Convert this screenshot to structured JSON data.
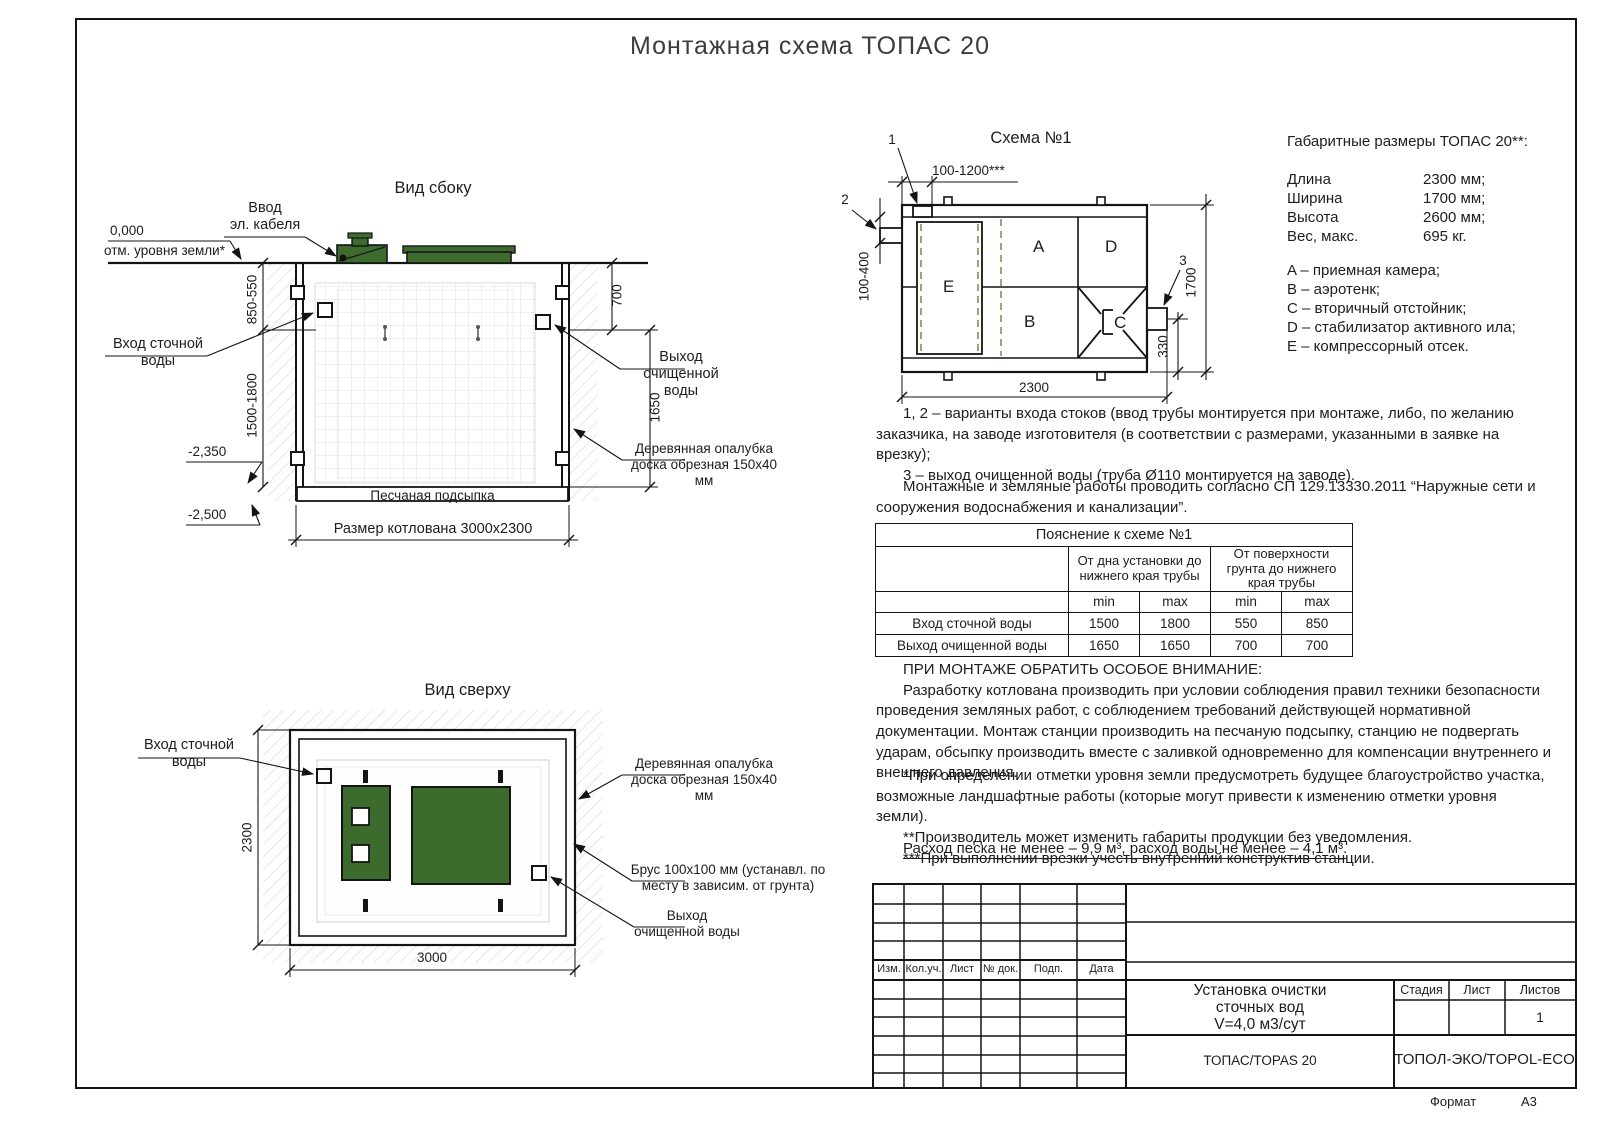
{
  "page": {
    "title": "Монтажная схема ТОПАС 20",
    "format_label": "Формат",
    "format_value": "А3"
  },
  "side_view": {
    "title": "Вид сбоку",
    "cable_1": "Ввод",
    "cable_2": "эл. кабеля",
    "zero_mark": "0,000",
    "zero_caption": "отм. уровня земли*",
    "inlet_1": "Вход сточной",
    "inlet_2": "воды",
    "outlet_1": "Выход очищенной",
    "outlet_2": "воды",
    "formwork_1": "Деревянная опалубка",
    "formwork_2": "доска обрезная 150x40 мм",
    "sand": "Песчаная подсыпка",
    "pit_size": "Размер котлована 3000x2300",
    "dim_in": "850-550",
    "dim_in2": "1500-1800",
    "dim_m2350": "-2,350",
    "dim_m2500": "-2,500",
    "dim_700": "700",
    "dim_1650": "1650"
  },
  "top_view": {
    "title": "Вид сверху",
    "inlet_1": "Вход сточной",
    "inlet_2": "воды",
    "formwork_1": "Деревянная опалубка",
    "formwork_2": "доска обрезная 150x40 мм",
    "beam_1": "Брус 100x100 мм (устанавл. по",
    "beam_2": "месту в зависим. от грунта)",
    "outlet_1": "Выход",
    "outlet_2": "очищенной воды",
    "dim_2300": "2300",
    "dim_3000": "3000"
  },
  "scheme": {
    "title": "Схема №1",
    "callout_1": "1",
    "callout_2": "2",
    "callout_3": "3",
    "chamber_a": "A",
    "chamber_b": "B",
    "chamber_c": "C",
    "chamber_d": "D",
    "chamber_e": "E",
    "dim_top": "100-1200***",
    "dim_left": "100-400",
    "dim_right": "1700",
    "dim_330": "330",
    "dim_bottom": "2300"
  },
  "specs": {
    "title": "Габаритные размеры ТОПАС 20**:",
    "rows": [
      {
        "name": "Длина",
        "value": "2300 мм;"
      },
      {
        "name": "Ширина",
        "value": "1700 мм;"
      },
      {
        "name": "Высота",
        "value": "2600 мм;"
      },
      {
        "name": "Вес, макс.",
        "value": "695 кг."
      }
    ],
    "legend": [
      "A – приемная камера;",
      "B – аэротенк;",
      "C – вторичный отстойник;",
      "D – стабилизатор активного ила;",
      "E – компрессорный отсек."
    ]
  },
  "notes": {
    "variants_1": "1, 2 – варианты входа  стоков (ввод трубы монтируется при монтаже, либо, по желанию заказчика, на заводе изготовителя (в соответствии с размерами, указанными в заявке на врезку);",
    "variants_2": "3 – выход очищенной воды (труба Ø110 монтируется на заводе).",
    "works": "Монтажные и земляные работы проводить согласно СП 129.13330.2011 “Наружные сети и сооружения водоснабжения и канализации”."
  },
  "table": {
    "title": "Пояснение к схеме №1",
    "group_1": "От дна установки до нижнего края трубы",
    "group_2": "От поверхности грунта до нижнего края трубы",
    "min_1": "min",
    "max_1": "max",
    "min_2": "min",
    "max_2": "max",
    "rows": [
      {
        "label": "Вход сточной воды",
        "v1": "1500",
        "v2": "1800",
        "v3": "550",
        "v4": "850"
      },
      {
        "label": "Выход очищенной воды",
        "v1": "1650",
        "v2": "1650",
        "v3": "700",
        "v4": "700"
      }
    ]
  },
  "attention": {
    "heading": "ПРИ МОНТАЖЕ ОБРАТИТЬ ОСОБОЕ ВНИМАНИЕ:",
    "body": "Разработку котлована производить при условии соблюдения правил техники безопасности проведения земляных работ, с соблюдением требований действующей нормативной документации. Монтаж станции производить на песчаную подсыпку, станцию не подвергать ударам, обсыпку производить вместе с заливкой одновременно для компенсации внутреннего и внешнего давления."
  },
  "footnotes": {
    "f1": "*При определении отметки уровня земли предусмотреть будущее благоустройство участка, возможные ландшафтные работы (которые могут привести к изменению отметки уровня земли).",
    "f2": "**Производитель может изменить габариты продукции без уведомления.",
    "f3": "***При выполнении врезки учесть внутренний конструктив станции."
  },
  "consumption": "Расход песка не менее – 9,9 м³, расход воды не менее – 4,1 м³.",
  "title_block": {
    "rev_headers": [
      "Изм.",
      "Кол.уч.",
      "Лист",
      "№ док.",
      "Подп.",
      "Дата"
    ],
    "doc_line_1": "Установка очистки",
    "doc_line_2": "сточных вод",
    "doc_line_3": "V=4,0 м3/сут",
    "stage": "Стадия",
    "sheet": "Лист",
    "sheets": "Листов",
    "sheets_value": "1",
    "product": "ТОПАС/TOPAS 20",
    "company": "ТОПОЛ-ЭКО/TOPOL-ECO"
  },
  "colors": {
    "lid_green": "#3d6b2e",
    "dash_green": "#6f9e53"
  }
}
